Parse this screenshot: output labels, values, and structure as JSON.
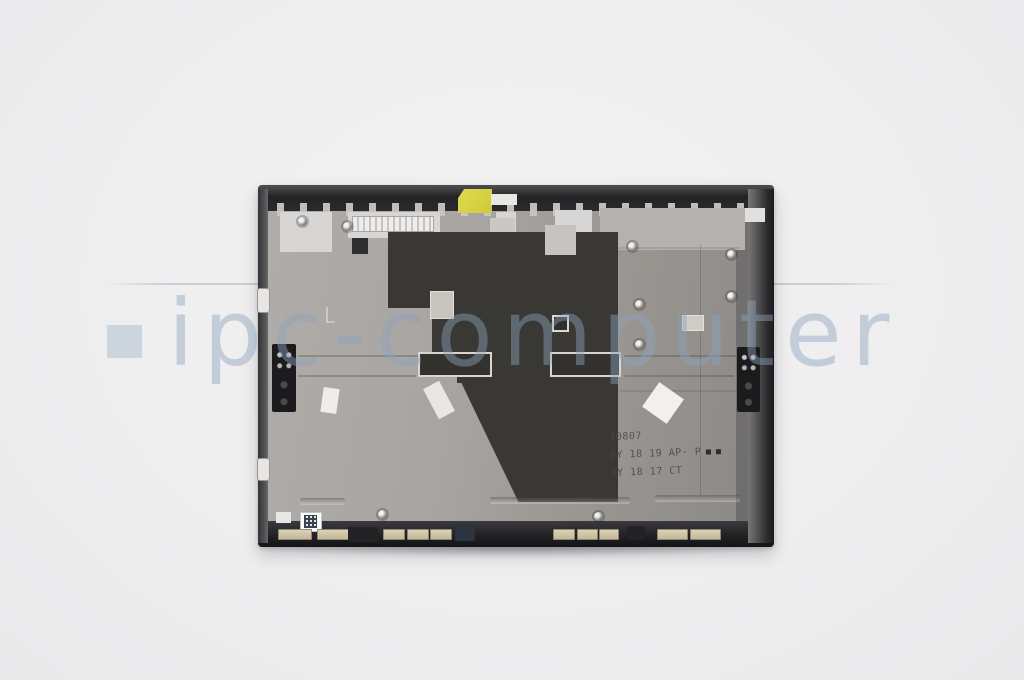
{
  "photo": {
    "type": "product-photo",
    "subject": "laptop-lcd-cover-inner-side",
    "background_color": "#efeeef"
  },
  "watermark": {
    "text": "ipc-computer",
    "text_color": "rgba(140,164,188,0.45)",
    "square_color": "#c6cfda"
  },
  "part": {
    "markings": {
      "line1": "10807",
      "line2": "DY 18 19 AP· P",
      "line3": "DY 18 17 CT",
      "corner_mark": "L"
    },
    "colors": {
      "bezel_dark": "#232325",
      "panel_gray": "#a8a4a1",
      "mylar_dark": "#3a3834",
      "sticker_yellow": "#d6d040",
      "pad_beige": "#cfc4a6"
    }
  }
}
